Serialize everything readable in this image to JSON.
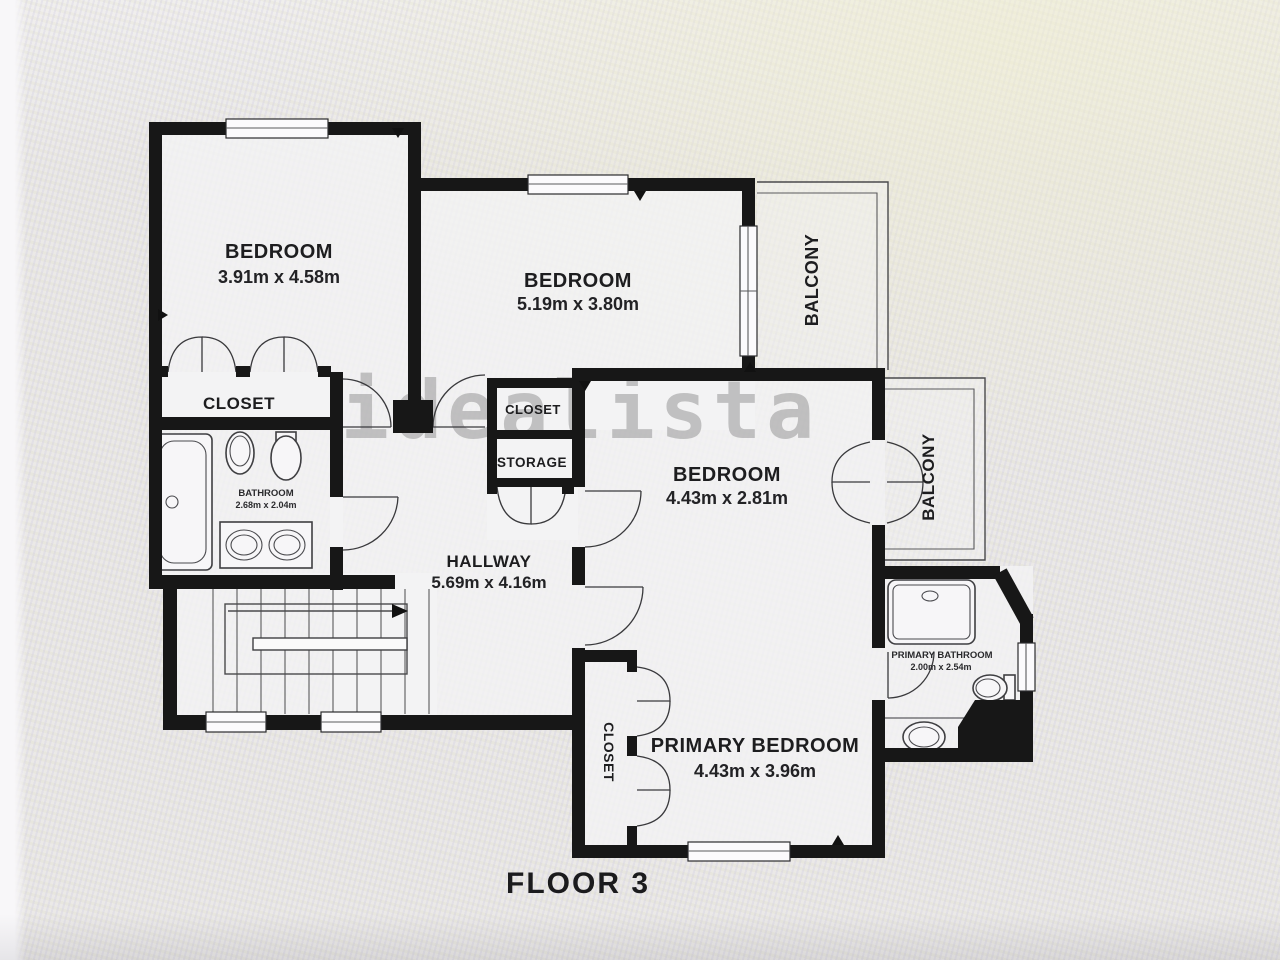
{
  "title": "FLOOR 3",
  "watermark": "idealista",
  "rooms": {
    "bedroom1": {
      "label": "BEDROOM",
      "dims": "3.91m x 4.58m"
    },
    "bedroom2": {
      "label": "BEDROOM",
      "dims": "5.19m x 3.80m"
    },
    "bedroom3": {
      "label": "BEDROOM",
      "dims": "4.43m x 2.81m"
    },
    "primary_bedroom": {
      "label": "PRIMARY BEDROOM",
      "dims": "4.43m x 3.96m"
    },
    "hallway": {
      "label": "HALLWAY",
      "dims": "5.69m x 4.16m"
    },
    "bathroom": {
      "label": "BATHROOM",
      "dims": "2.68m x 2.04m"
    },
    "primary_bathroom": {
      "label": "PRIMARY BATHROOM",
      "dims": "2.00m x 2.54m"
    },
    "balcony_top": {
      "label": "BALCONY"
    },
    "balcony_right": {
      "label": "BALCONY"
    },
    "closet_bedroom1": {
      "label": "CLOSET"
    },
    "closet_hall": {
      "label": "CLOSET"
    },
    "storage": {
      "label": "STORAGE"
    },
    "closet_primary": {
      "label": "CLOSET"
    }
  },
  "colors": {
    "wall": "#171717",
    "background": "#e8e6e4",
    "watermark_gray": "#8f8f8f",
    "text": "#1d1d1f"
  }
}
